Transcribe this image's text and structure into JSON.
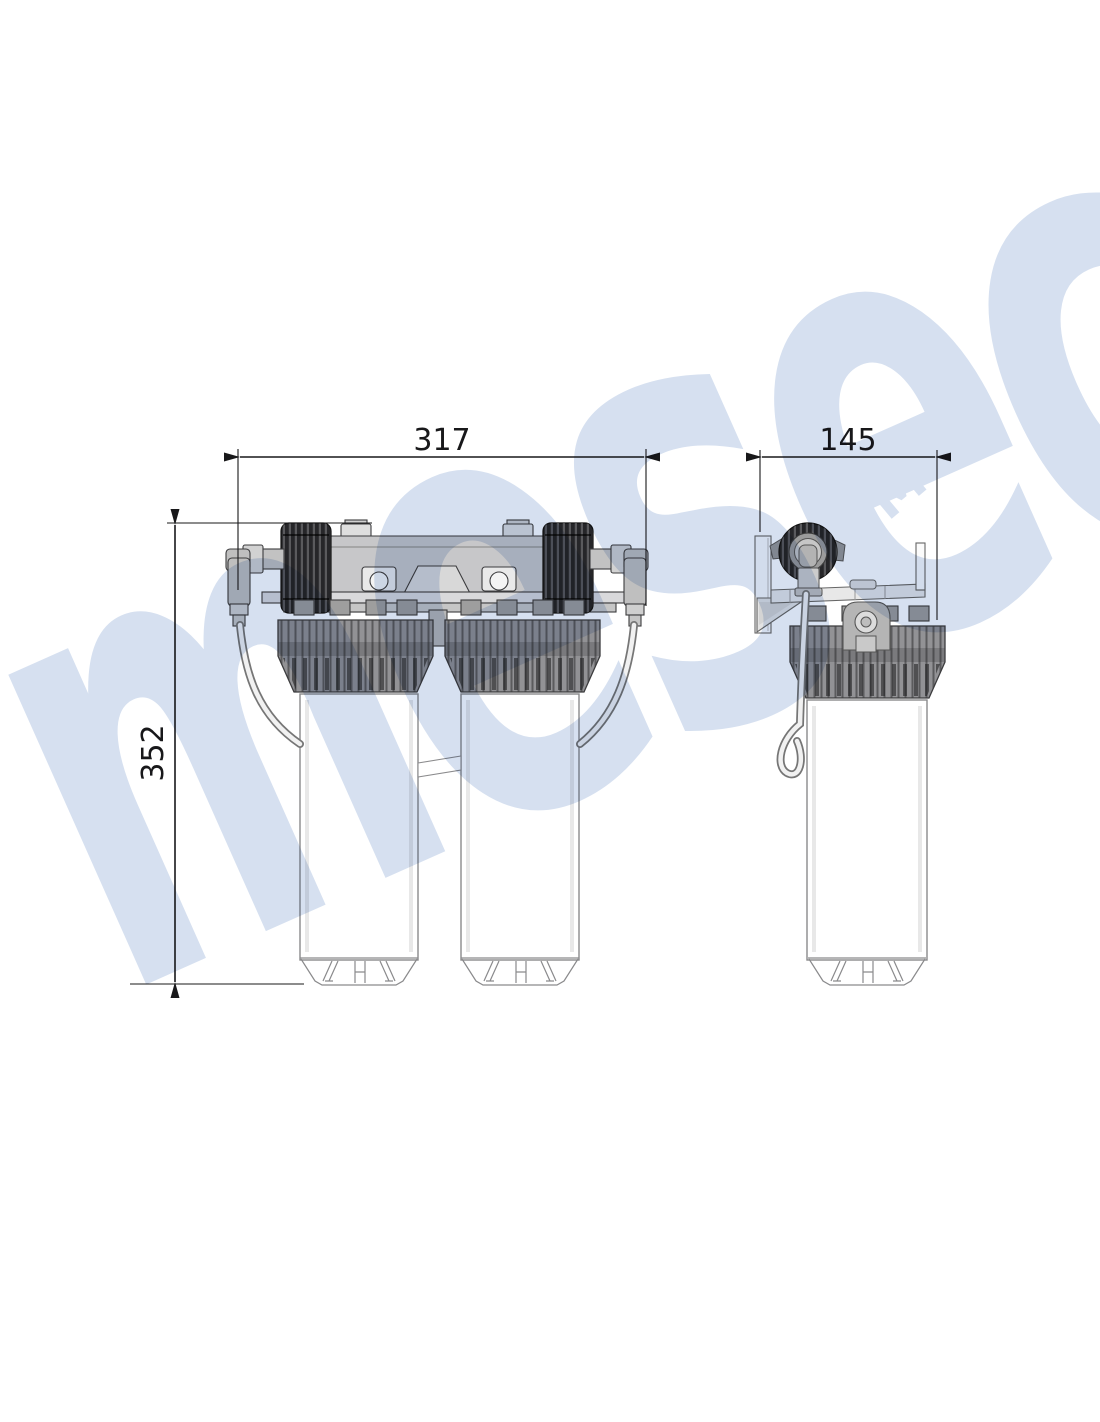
{
  "page": {
    "background": "#ffffff"
  },
  "dimensions": {
    "front_width": "317",
    "front_height": "352",
    "side_depth": "145"
  },
  "watermark": {
    "text": "mesec",
    "badge": "BM"
  },
  "colors": {
    "bg": "#ffffff",
    "line": "#3c3c3e",
    "dim": "#18181a",
    "body-light": "#c7c7c9",
    "plate": "#d9d9db",
    "collar": "#929295",
    "collar-band": "#7a7a7d",
    "cap": "#262629",
    "housing-line": "#8a8a8c",
    "wm": "#ccd9ec"
  }
}
